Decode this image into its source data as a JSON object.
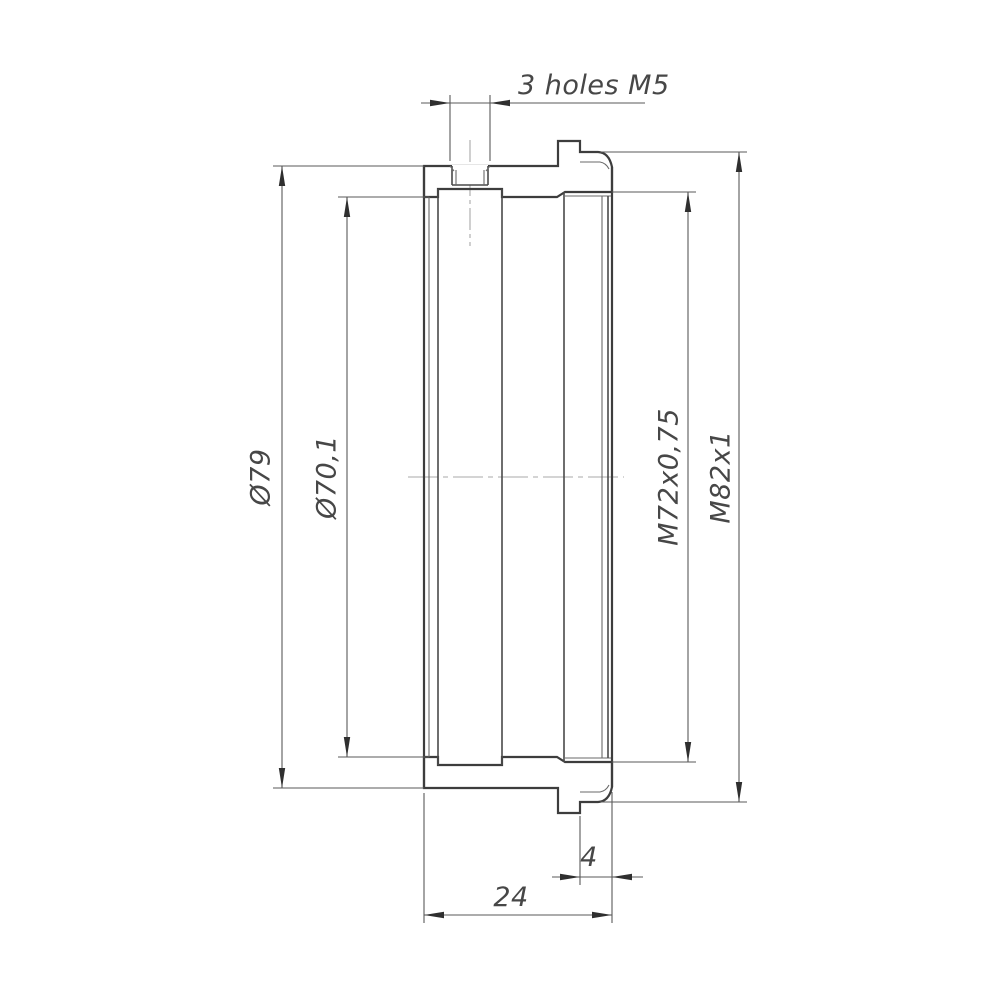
{
  "drawing": {
    "note_holes": "3 holes M5",
    "dim_outer_diameter": "Ø79",
    "dim_bore_diameter": "Ø70,1",
    "dim_thread_inner": "M72x0,75",
    "dim_thread_outer": "M82x1",
    "dim_step_length": "4",
    "dim_overall_length": "24",
    "colors": {
      "outline": "#3d3d3d",
      "thin_line": "#5a5a5a",
      "hatch": "#6b6b6b",
      "centerline": "#a8a8a8",
      "background": "#ffffff"
    }
  }
}
